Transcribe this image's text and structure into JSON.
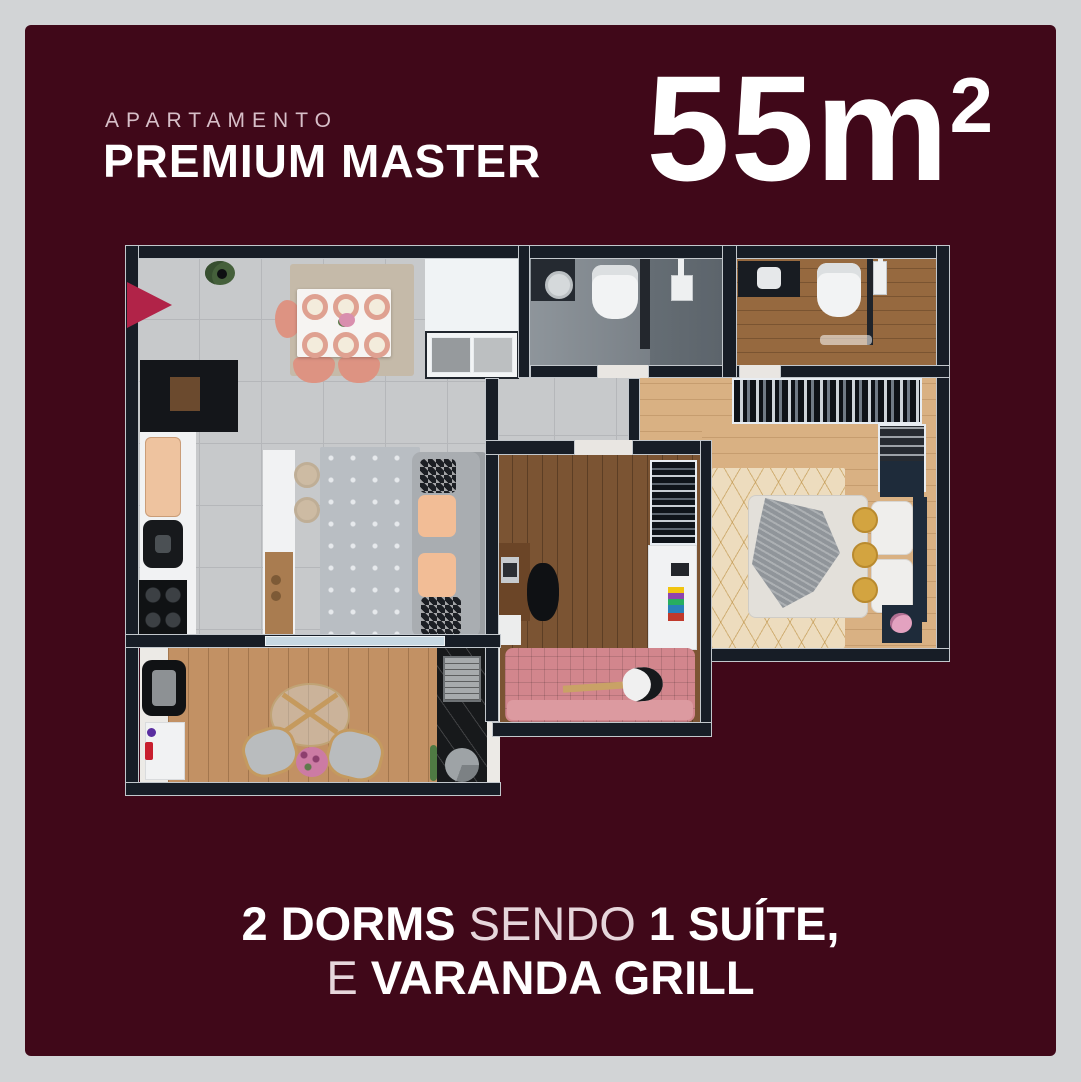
{
  "header": {
    "kicker": "APARTAMENTO",
    "title": "PREMIUM MASTER",
    "area_value": "55m",
    "area_sup": "2"
  },
  "footer": {
    "line1_bold1": "2 DORMS",
    "line1_regular": "SENDO",
    "line1_bold2": "1 SUÍTE,",
    "line2_regular": "E",
    "line2_bold": "VARANDA GRILL"
  },
  "colors": {
    "canvas_background": "#d2d4d6",
    "card_background": "#400819",
    "text_primary": "#ffffff",
    "text_muted": "#d7bfc8",
    "entrance_arrow": "#b12348",
    "wall": "#171d26",
    "pink_accent": "#dd9685"
  },
  "floorplan": {
    "rooms": [
      "kitchen-dining",
      "living-room",
      "hall",
      "laundry-closet",
      "social-bathroom",
      "suite-bathroom",
      "walk-in-closet",
      "master-suite",
      "bedroom-2",
      "varanda-grill"
    ],
    "icons": [
      "entrance-arrow"
    ]
  }
}
